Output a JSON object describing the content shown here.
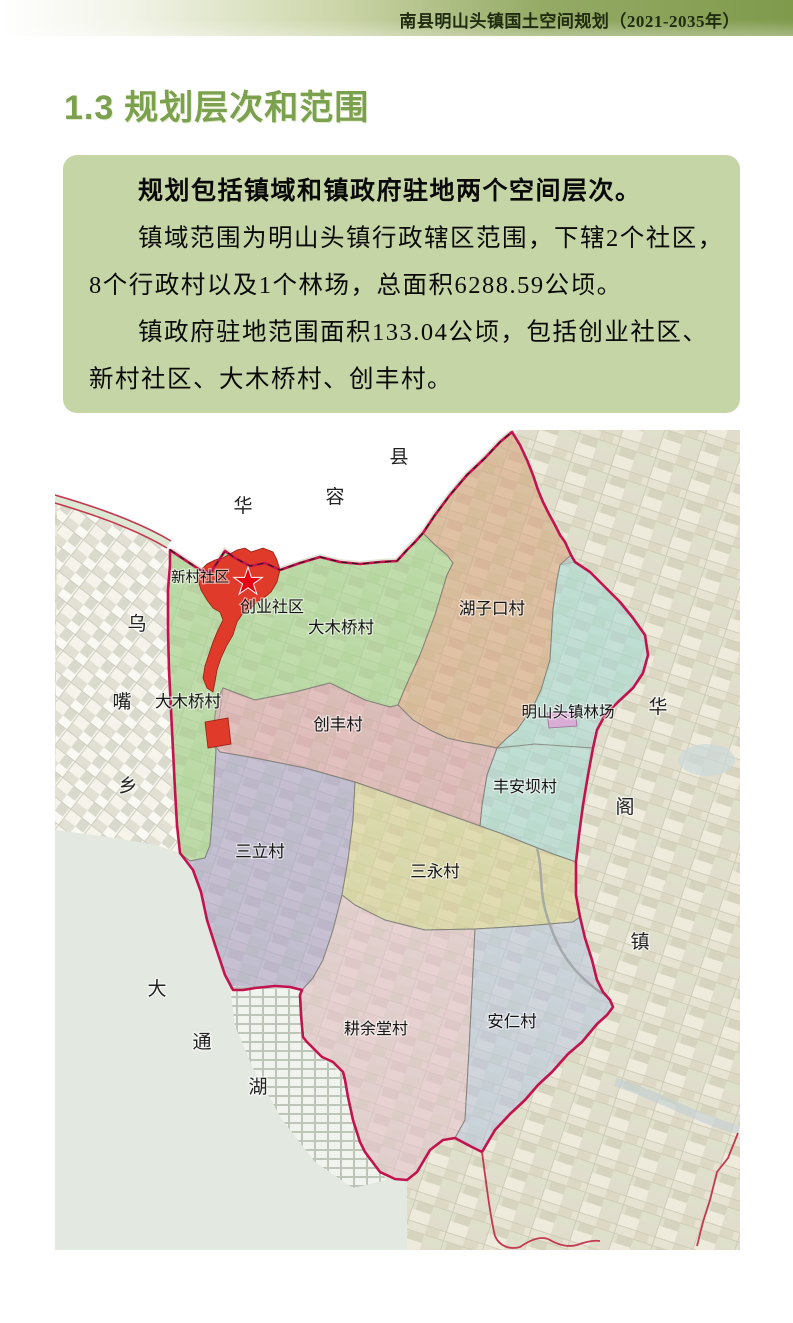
{
  "header": {
    "title": "南县明山头镇国土空间规划（2021-2035年）"
  },
  "section": {
    "number": "1.3",
    "title": "规划层次和范围"
  },
  "summary_box": {
    "lines": [
      {
        "text": "规划包括镇域和镇政府驻地两个空间层次。",
        "bold": true,
        "indent": true
      },
      {
        "text": "镇域范围为明山头镇行政辖区范围，下辖2个社区，",
        "bold": false,
        "indent": true
      },
      {
        "text": "8个行政村以及1个林场，总面积6288.59公顷。",
        "bold": false,
        "indent": false
      },
      {
        "text": "镇政府驻地范围面积133.04公顷，包括创业社区、",
        "bold": false,
        "indent": true
      },
      {
        "text": "新村社区、大木桥村、创丰村。",
        "bold": false,
        "indent": false
      }
    ]
  },
  "map": {
    "caption": "明山头镇行政辖区与镇政府驻地范围图",
    "boundary_color": "#c2134e",
    "internal_border_color": "#7d7d74",
    "star": {
      "x": 193,
      "y": 152,
      "color": "#e60012"
    },
    "regions": [
      {
        "name": "新村社区",
        "color": "#e03a2a",
        "label_x": 145,
        "label_y": 152,
        "font": 14.5
      },
      {
        "name": "创业社区",
        "color": "#e03a2a",
        "label_x": 217,
        "label_y": 182,
        "font": 16
      },
      {
        "name": "大木桥村",
        "color": "#a9d69a",
        "label_x": 286,
        "label_y": 203,
        "font": 16.5
      },
      {
        "name": "湖子口村",
        "color": "#dcab8c",
        "label_x": 437,
        "label_y": 184,
        "font": 16.5
      },
      {
        "name": "明山头镇林场",
        "color": "#aedbde",
        "label_x": 513,
        "label_y": 287,
        "font": 15.5
      },
      {
        "name": "大木桥村",
        "color": "#a9d69a",
        "label_x": 133,
        "label_y": 277,
        "font": 16.5
      },
      {
        "name": "创丰村",
        "color": "#ddaab6",
        "label_x": 283,
        "label_y": 300,
        "font": 16.5
      },
      {
        "name": "丰安坝村",
        "color": "#aedbde",
        "label_x": 470,
        "label_y": 362,
        "font": 16
      },
      {
        "name": "三立村",
        "color": "#b2aad8",
        "label_x": 205,
        "label_y": 427,
        "font": 16.5
      },
      {
        "name": "三永村",
        "color": "#dcd5a2",
        "label_x": 380,
        "label_y": 447,
        "font": 16.5
      },
      {
        "name": "耕余堂村",
        "color": "#e6c6d6",
        "label_x": 321,
        "label_y": 604,
        "font": 16
      },
      {
        "name": "安仁村",
        "color": "#c2cce8",
        "label_x": 457,
        "label_y": 597,
        "font": 16.5
      }
    ],
    "adjacent_labels": [
      {
        "text": "华",
        "x": 188,
        "y": 82
      },
      {
        "text": "容",
        "x": 280,
        "y": 73
      },
      {
        "text": "县",
        "x": 344,
        "y": 33
      },
      {
        "text": "乌",
        "x": 82,
        "y": 200
      },
      {
        "text": "嘴",
        "x": 67,
        "y": 278
      },
      {
        "text": "乡",
        "x": 73,
        "y": 362
      },
      {
        "text": "大",
        "x": 102,
        "y": 565
      },
      {
        "text": "通",
        "x": 147,
        "y": 618
      },
      {
        "text": "湖",
        "x": 203,
        "y": 663
      },
      {
        "text": "华",
        "x": 603,
        "y": 283
      },
      {
        "text": "阁",
        "x": 570,
        "y": 383
      },
      {
        "text": "镇",
        "x": 585,
        "y": 518
      }
    ]
  },
  "theme": {
    "header_green": "#7f9a4b",
    "title_green": "#7ba04e",
    "box_green": "#c6d5a6",
    "town_seat_red": "#e03a2a",
    "boundary_magenta": "#c2134e"
  }
}
